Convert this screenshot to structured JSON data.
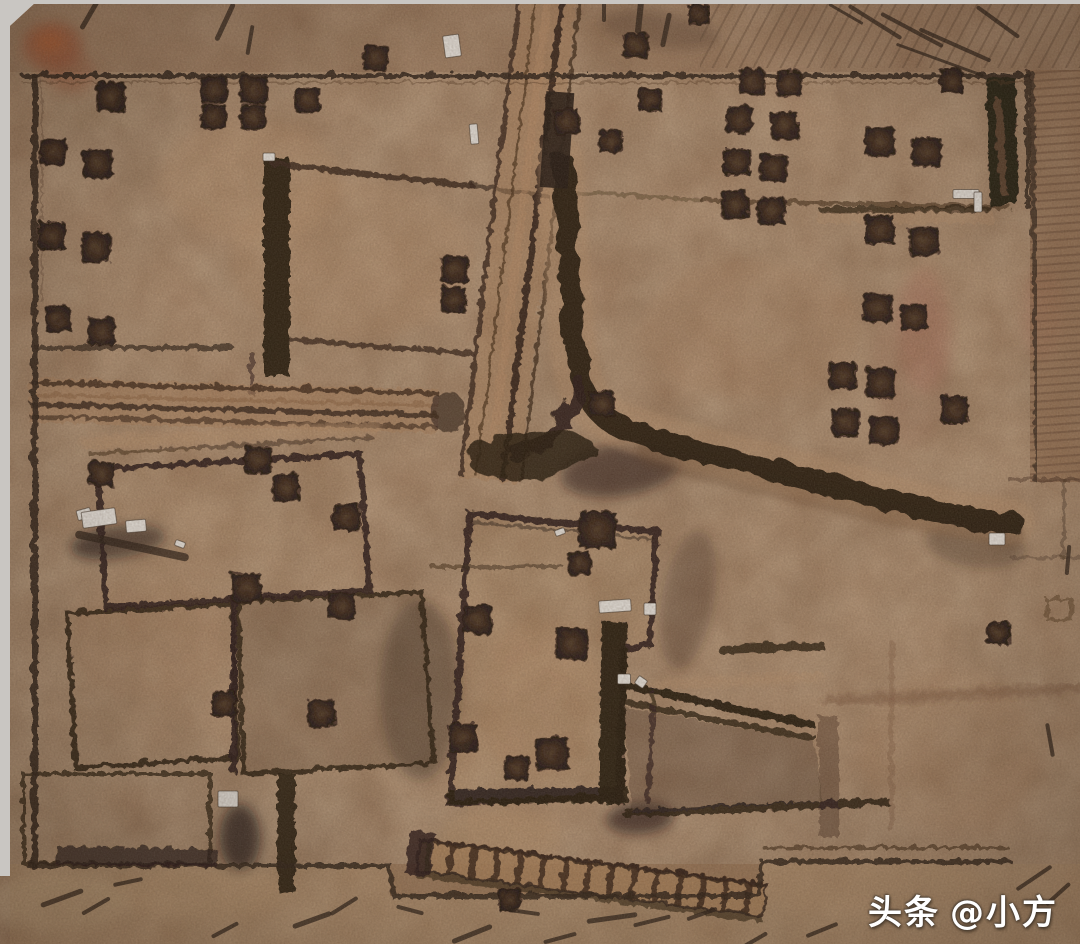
{
  "scene": {
    "description": "Aerial drone orthophoto of an archaeological excavation site with trench walls, room foundations and square test pits",
    "setting": "excavated earthen site, top-down view"
  },
  "watermark": {
    "prefix": "头条",
    "handle": "@小方"
  },
  "palette": {
    "frame_gray": "#c9c6c2",
    "ground_base": "#9c7453",
    "ground_light": "#b8906a",
    "trench_dark": "#170c06",
    "pit_core": "#2e1b0f",
    "red_stain": "#a8401d",
    "white_marker": "#e8e6e1"
  },
  "features": {
    "test_pits": [
      [
        374,
        56,
        24,
        3
      ],
      [
        634,
        44,
        24,
        -2
      ],
      [
        697,
        13,
        20,
        0
      ],
      [
        109,
        95,
        28,
        2
      ],
      [
        212,
        88,
        26,
        -2
      ],
      [
        252,
        88,
        26,
        2
      ],
      [
        212,
        115,
        24,
        2
      ],
      [
        251,
        115,
        24,
        -2
      ],
      [
        306,
        98,
        24,
        0
      ],
      [
        52,
        150,
        26,
        2
      ],
      [
        96,
        162,
        28,
        -3
      ],
      [
        50,
        234,
        26,
        0
      ],
      [
        94,
        246,
        28,
        3
      ],
      [
        56,
        318,
        24,
        -2
      ],
      [
        100,
        330,
        26,
        2
      ],
      [
        565,
        120,
        24,
        -3
      ],
      [
        609,
        140,
        22,
        2
      ],
      [
        648,
        98,
        22,
        0
      ],
      [
        750,
        80,
        24,
        2
      ],
      [
        787,
        82,
        24,
        -2
      ],
      [
        950,
        80,
        22,
        0
      ],
      [
        738,
        118,
        26,
        3
      ],
      [
        783,
        124,
        26,
        -2
      ],
      [
        735,
        160,
        26,
        0
      ],
      [
        772,
        166,
        26,
        2
      ],
      [
        733,
        203,
        26,
        -3
      ],
      [
        770,
        209,
        26,
        2
      ],
      [
        878,
        140,
        28,
        -2
      ],
      [
        925,
        150,
        28,
        2
      ],
      [
        878,
        228,
        28,
        0
      ],
      [
        922,
        240,
        28,
        -3
      ],
      [
        876,
        306,
        28,
        2
      ],
      [
        912,
        316,
        26,
        -2
      ],
      [
        841,
        374,
        26,
        0
      ],
      [
        879,
        381,
        28,
        3
      ],
      [
        844,
        421,
        26,
        -2
      ],
      [
        882,
        429,
        28,
        2
      ],
      [
        953,
        408,
        26,
        0
      ],
      [
        453,
        268,
        26,
        -2
      ],
      [
        452,
        298,
        24,
        2
      ],
      [
        600,
        402,
        24,
        0
      ],
      [
        596,
        528,
        36,
        2
      ],
      [
        578,
        562,
        22,
        -3
      ],
      [
        570,
        642,
        30,
        2
      ],
      [
        256,
        458,
        26,
        2
      ],
      [
        284,
        486,
        26,
        -2
      ],
      [
        345,
        516,
        26,
        0
      ],
      [
        100,
        472,
        24,
        3
      ],
      [
        245,
        586,
        28,
        -2
      ],
      [
        340,
        604,
        26,
        2
      ],
      [
        222,
        702,
        24,
        0
      ],
      [
        320,
        712,
        26,
        -2
      ],
      [
        476,
        618,
        28,
        2
      ],
      [
        461,
        736,
        28,
        0
      ],
      [
        550,
        752,
        32,
        -2
      ],
      [
        515,
        766,
        24,
        2
      ],
      [
        997,
        632,
        22,
        0
      ],
      [
        508,
        898,
        22,
        0
      ]
    ],
    "white_markers": [
      [
        452,
        46,
        16,
        22,
        -8
      ],
      [
        474,
        134,
        8,
        20,
        -5
      ],
      [
        269,
        157,
        12,
        8,
        0
      ],
      [
        966,
        194,
        26,
        9,
        0
      ],
      [
        978,
        202,
        8,
        20,
        0
      ],
      [
        84,
        514,
        14,
        10,
        -15
      ],
      [
        99,
        518,
        34,
        16,
        -8
      ],
      [
        136,
        526,
        20,
        12,
        -5
      ],
      [
        180,
        544,
        10,
        6,
        20
      ],
      [
        228,
        799,
        20,
        16,
        0
      ],
      [
        615,
        606,
        32,
        12,
        -4
      ],
      [
        650,
        609,
        12,
        12,
        0
      ],
      [
        624,
        679,
        13,
        10,
        0
      ],
      [
        641,
        682,
        10,
        9,
        35
      ],
      [
        997,
        539,
        16,
        12,
        0
      ],
      [
        560,
        532,
        10,
        6,
        -20
      ]
    ],
    "scratch_marks": [
      [
        90,
        14,
        30,
        5,
        120
      ],
      [
        225,
        22,
        36,
        5,
        115
      ],
      [
        250,
        40,
        26,
        4,
        100
      ],
      [
        604,
        8,
        24,
        4,
        90
      ],
      [
        640,
        12,
        38,
        6,
        96
      ],
      [
        666,
        30,
        30,
        5,
        102
      ],
      [
        846,
        14,
        36,
        3,
        30
      ],
      [
        875,
        22,
        58,
        4,
        32
      ],
      [
        912,
        30,
        66,
        4,
        28
      ],
      [
        955,
        45,
        74,
        4,
        24
      ],
      [
        998,
        22,
        48,
        4,
        36
      ],
      [
        940,
        60,
        90,
        3,
        20
      ],
      [
        132,
        546,
        108,
        8,
        12
      ],
      [
        62,
        898,
        40,
        5,
        160
      ],
      [
        96,
        906,
        28,
        4,
        150
      ],
      [
        128,
        882,
        26,
        4,
        168
      ],
      [
        225,
        930,
        26,
        4,
        152
      ],
      [
        312,
        920,
        36,
        5,
        160
      ],
      [
        344,
        906,
        28,
        4,
        148
      ],
      [
        410,
        910,
        24,
        4,
        15
      ],
      [
        472,
        934,
        38,
        5,
        158
      ],
      [
        524,
        912,
        28,
        4,
        8
      ],
      [
        612,
        918,
        46,
        5,
        172
      ],
      [
        652,
        921,
        34,
        4,
        166
      ],
      [
        702,
        914,
        28,
        4,
        160
      ],
      [
        822,
        930,
        30,
        4,
        158
      ],
      [
        1034,
        878,
        38,
        4,
        146
      ],
      [
        1058,
        894,
        28,
        4,
        138
      ],
      [
        560,
        938,
        30,
        4,
        165
      ],
      [
        755,
        940,
        24,
        4,
        150
      ],
      [
        1068,
        560,
        26,
        4,
        95
      ],
      [
        1050,
        740,
        30,
        4,
        80
      ]
    ],
    "soft_patches": [
      [
        350,
        260,
        120,
        80,
        "#b8906a",
        0.32,
        0
      ],
      [
        250,
        180,
        90,
        60,
        "#bb926b",
        0.28,
        0
      ],
      [
        750,
        330,
        110,
        70,
        "#a97f5b",
        0.28,
        0
      ],
      [
        540,
        700,
        60,
        80,
        "#b08662",
        0.28,
        0
      ],
      [
        500,
        835,
        60,
        26,
        "#c09a6e",
        0.4,
        0
      ],
      [
        860,
        882,
        120,
        30,
        "#bb9672",
        0.4,
        0
      ],
      [
        200,
        892,
        90,
        26,
        "#c4a078",
        0.38,
        0
      ],
      [
        58,
        902,
        70,
        30,
        "#cbb18c",
        0.45,
        0
      ],
      [
        950,
        750,
        90,
        80,
        "#a87e5a",
        0.25,
        0
      ],
      [
        150,
        640,
        80,
        60,
        "#9a7050",
        0.25,
        0
      ],
      [
        52,
        46,
        30,
        24,
        "#a8401d",
        0.55,
        0
      ],
      [
        50,
        42,
        14,
        11,
        "#c85a24",
        0.6,
        0
      ],
      [
        70,
        72,
        26,
        20,
        "#9c4526",
        0.35,
        0
      ],
      [
        925,
        330,
        26,
        62,
        "#b05648",
        0.2,
        0
      ],
      [
        1042,
        315,
        20,
        48,
        "#b05648",
        0.15,
        0
      ],
      [
        912,
        365,
        40,
        80,
        "#8a4a3a",
        0.12,
        0
      ],
      [
        118,
        542,
        48,
        16,
        "#140d08",
        0.7,
        -8
      ],
      [
        240,
        838,
        20,
        34,
        "#170f09",
        0.75,
        0
      ],
      [
        660,
        30,
        60,
        18,
        "#3f2b1b",
        0.45,
        8
      ],
      [
        420,
        690,
        40,
        90,
        "#241509",
        0.4,
        0
      ],
      [
        688,
        600,
        26,
        70,
        "#2a1810",
        0.35,
        10
      ],
      [
        975,
        545,
        50,
        22,
        "#241509",
        0.3,
        8
      ],
      [
        640,
        818,
        34,
        16,
        "#1c1009",
        0.7,
        -4
      ],
      [
        620,
        470,
        60,
        26,
        "#1d1008",
        0.6,
        -8
      ]
    ]
  }
}
